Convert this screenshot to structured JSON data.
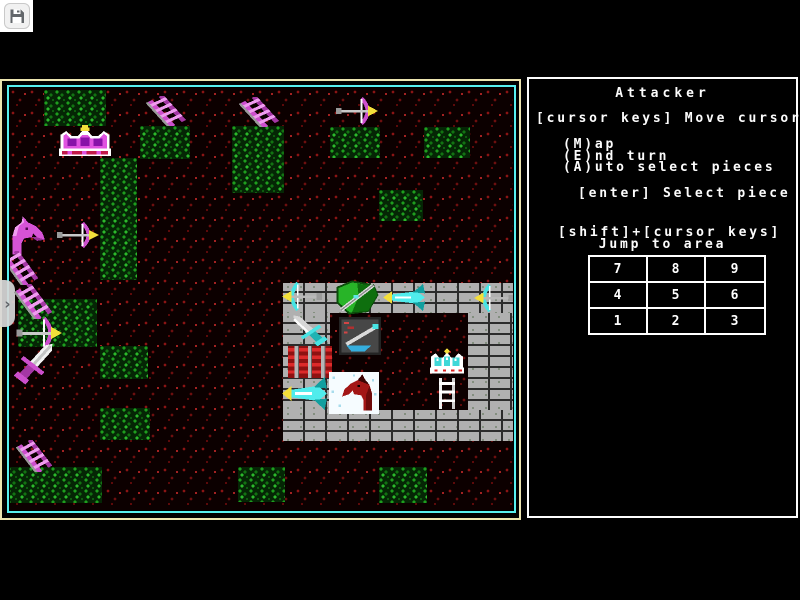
{
  "window": {
    "background": "#000000"
  },
  "toolbar": {
    "save_icon": "floppy-disk-icon"
  },
  "side_tab": {
    "chevron": "›"
  },
  "game": {
    "colors": {
      "screen_border_outer": "#ece5b0",
      "map_border_cyan": "#57efef",
      "panel_border": "#fdfdfd",
      "panel_text": "#fcfcfc",
      "attacker_magenta": "#d653d6",
      "defender_cyan": "#55ffff",
      "forest_green": "#1e9e1e",
      "ground_red": "#8a1414",
      "brick_gray": "#b0b0b0"
    },
    "map": {
      "patches": [
        {
          "x": 34,
          "y": 2,
          "w": 62,
          "h": 36
        },
        {
          "x": 130,
          "y": 38,
          "w": 50,
          "h": 33
        },
        {
          "x": 222,
          "y": 38,
          "w": 52,
          "h": 67
        },
        {
          "x": 320,
          "y": 39,
          "w": 50,
          "h": 31
        },
        {
          "x": 414,
          "y": 39,
          "w": 46,
          "h": 31
        },
        {
          "x": 90,
          "y": 70,
          "w": 37,
          "h": 122
        },
        {
          "x": 369,
          "y": 102,
          "w": 44,
          "h": 31
        },
        {
          "x": 8,
          "y": 211,
          "w": 79,
          "h": 48
        },
        {
          "x": 90,
          "y": 258,
          "w": 48,
          "h": 33
        },
        {
          "x": 90,
          "y": 320,
          "w": 50,
          "h": 32
        },
        {
          "x": -3,
          "y": 379,
          "w": 95,
          "h": 36
        },
        {
          "x": 228,
          "y": 379,
          "w": 47,
          "h": 35
        },
        {
          "x": 369,
          "y": 379,
          "w": 48,
          "h": 36
        }
      ],
      "castle": {
        "x": 273,
        "y": 195,
        "w": 234,
        "h": 158,
        "walls": [
          {
            "x": 0,
            "y": 0,
            "w": 234,
            "h": 30
          },
          {
            "x": 0,
            "y": 30,
            "w": 47,
            "h": 97
          },
          {
            "x": 185,
            "y": 30,
            "w": 49,
            "h": 97
          },
          {
            "x": 0,
            "y": 127,
            "w": 234,
            "h": 31
          }
        ]
      },
      "pieces": [
        {
          "type": "crown-magenta",
          "x": 46,
          "y": 37,
          "w": 58,
          "h": 32
        },
        {
          "type": "ladder-magenta",
          "x": 136,
          "y": 8,
          "w": 42,
          "h": 30
        },
        {
          "type": "ladder-magenta",
          "x": 229,
          "y": 9,
          "w": 42,
          "h": 30
        },
        {
          "type": "bow-magenta-right",
          "x": 324,
          "y": 8,
          "w": 44,
          "h": 30
        },
        {
          "type": "horse-magenta",
          "x": -4,
          "y": 127,
          "w": 44,
          "h": 42
        },
        {
          "type": "bow-magenta-right",
          "x": 45,
          "y": 133,
          "w": 44,
          "h": 28
        },
        {
          "type": "ladder-magenta",
          "x": -8,
          "y": 163,
          "w": 38,
          "h": 34
        },
        {
          "type": "ladder-magenta",
          "x": 4,
          "y": 196,
          "w": 40,
          "h": 35
        },
        {
          "type": "bow-magenta-right",
          "x": 4,
          "y": 228,
          "w": 48,
          "h": 34
        },
        {
          "type": "sword-magenta",
          "x": -2,
          "y": 250,
          "w": 54,
          "h": 50
        },
        {
          "type": "ladder-magenta",
          "x": 6,
          "y": 352,
          "w": 38,
          "h": 32
        },
        {
          "type": "bow-cyan-left",
          "x": 272,
          "y": 193,
          "w": 42,
          "h": 31
        },
        {
          "type": "shield-green",
          "x": 322,
          "y": 191,
          "w": 48,
          "h": 37
        },
        {
          "type": "winged-arrow-cyan-left",
          "x": 373,
          "y": 196,
          "w": 44,
          "h": 27
        },
        {
          "type": "bow-cyan-left",
          "x": 464,
          "y": 195,
          "w": 42,
          "h": 30
        },
        {
          "type": "sword-gray-cyan",
          "x": 275,
          "y": 223,
          "w": 48,
          "h": 38
        },
        {
          "type": "sword-emblem-tile",
          "x": 329,
          "y": 229,
          "w": 42,
          "h": 38
        },
        {
          "type": "gate-red",
          "x": 278,
          "y": 258,
          "w": 44,
          "h": 32
        },
        {
          "type": "crown-cyan",
          "x": 418,
          "y": 260,
          "w": 38,
          "h": 30
        },
        {
          "type": "winged-arrow-cyan-left",
          "x": 272,
          "y": 289,
          "w": 47,
          "h": 33
        },
        {
          "type": "horse-red-tile",
          "x": 319,
          "y": 284,
          "w": 50,
          "h": 42
        },
        {
          "type": "ladder-white",
          "x": 427,
          "y": 290,
          "w": 20,
          "h": 31
        }
      ]
    },
    "panel": {
      "title": "Attacker",
      "cursor_hint": "[cursor keys] Move cursor",
      "menu_items": [
        "(M)ap",
        "(E)nd turn",
        "(A)uto select pieces"
      ],
      "select_hint": "[enter] Select piece",
      "jump_hint_line1": "[shift]+[cursor keys]",
      "jump_hint_line2": "Jump to area",
      "jump_grid": [
        [
          "7",
          "8",
          "9"
        ],
        [
          "4",
          "5",
          "6"
        ],
        [
          "1",
          "2",
          "3"
        ]
      ]
    }
  }
}
